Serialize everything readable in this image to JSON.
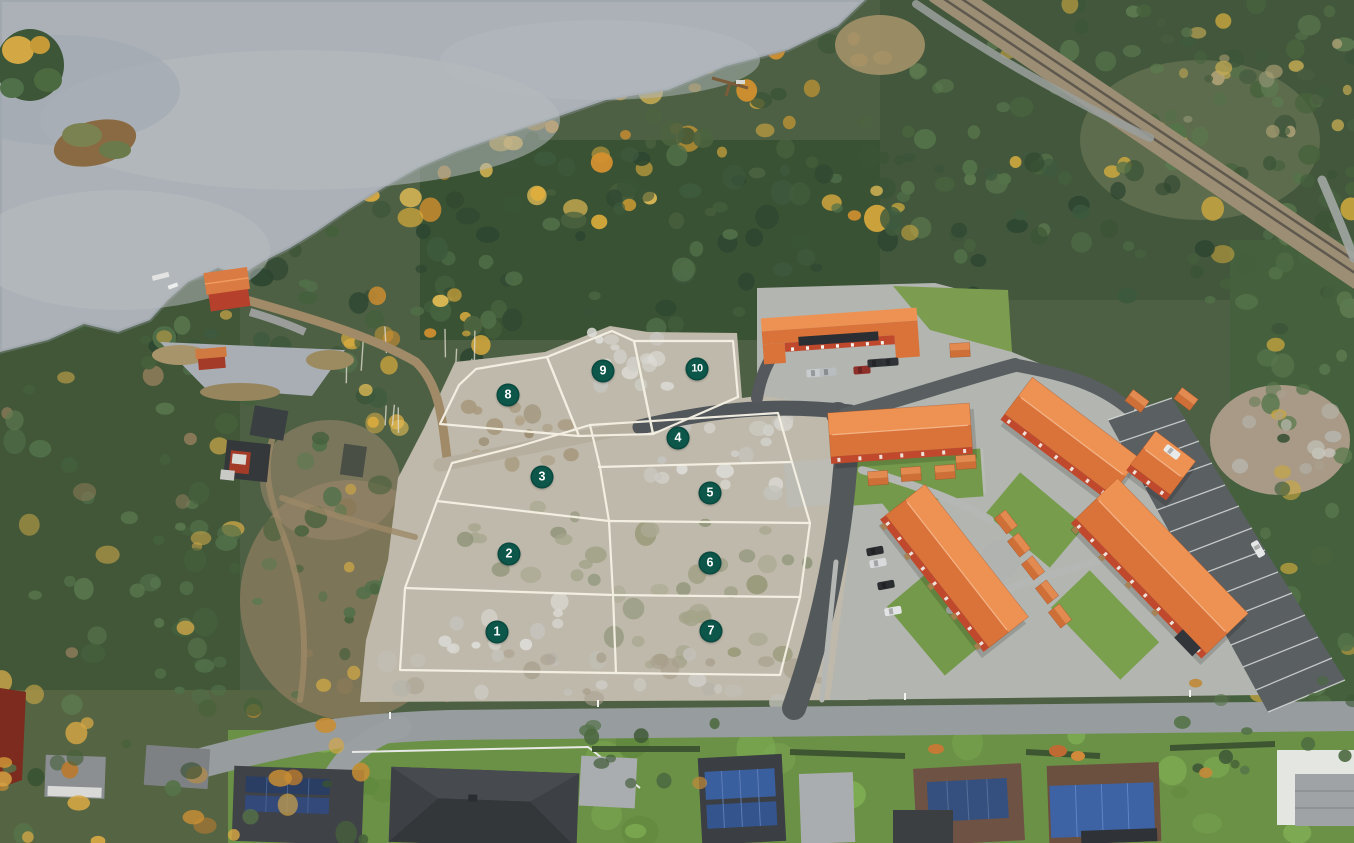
{
  "overlay": {
    "plots": [
      {
        "label": "1"
      },
      {
        "label": "2"
      },
      {
        "label": "3"
      },
      {
        "label": "4"
      },
      {
        "label": "5"
      },
      {
        "label": "6"
      },
      {
        "label": "7"
      },
      {
        "label": "8"
      },
      {
        "label": "9"
      },
      {
        "label": "10"
      }
    ],
    "marker_style": {
      "fill": "#0d564a",
      "text_color": "#ffffff"
    },
    "boundary_line_color": "#f4f0e3"
  }
}
